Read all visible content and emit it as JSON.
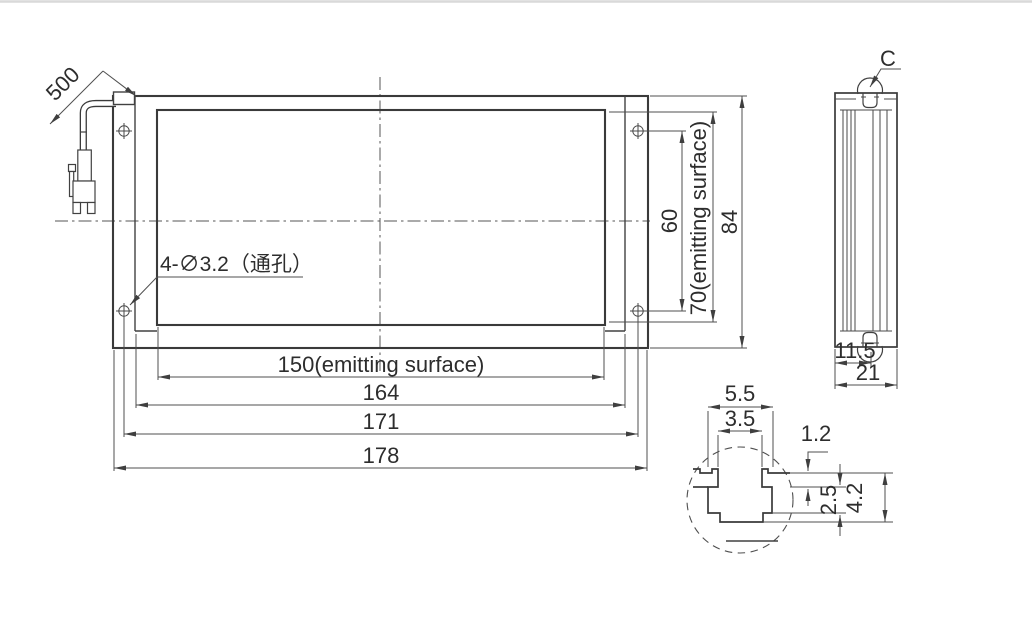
{
  "drawing": {
    "front_view": {
      "cable_length": "500",
      "hole_callout": "4-∅3.2（通孔）",
      "dim_emitting_width": "150(emitting surface)",
      "dim_body_width": "164",
      "dim_hole_spacing_h": "171",
      "dim_overall_width": "178",
      "dim_hole_spacing_v": "60",
      "dim_emitting_height": "70(emitting surface)",
      "dim_overall_height": "84"
    },
    "side_view": {
      "detail_label": "C",
      "dim_groove_offset": "11.5",
      "dim_depth": "21"
    },
    "detail_view": {
      "dim_cavity_width": "5.5",
      "dim_slot_width": "3.5",
      "dim_lip_thickness": "1.2",
      "dim_cavity_depth": "2.5",
      "dim_total_height": "4.2"
    }
  },
  "colors": {
    "outline": "#3a3a3a",
    "dimension_line": "#4f4f4f",
    "text": "#2d2d2d",
    "background": "#ffffff",
    "top_border": "#d9d9d9"
  }
}
